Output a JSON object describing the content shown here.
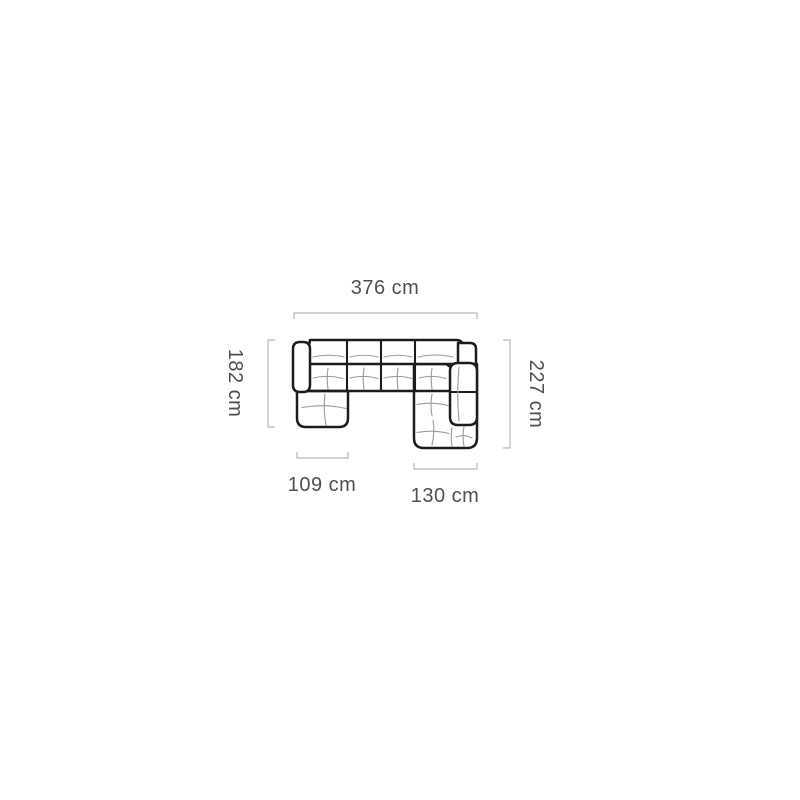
{
  "page": {
    "background_color": "#ffffff"
  },
  "diagram": {
    "subject": "u-shaped-corner-sofa-top-view",
    "unit": "cm",
    "dimensions": {
      "total_width": {
        "label": "376 cm",
        "value_cm": 376
      },
      "left_side_depth": {
        "label": "182 cm",
        "value_cm": 182
      },
      "right_side_depth": {
        "label": "227 cm",
        "value_cm": 227
      },
      "left_chaise_width": {
        "label": "109 cm",
        "value_cm": 109
      },
      "right_chaise_width": {
        "label": "130 cm",
        "value_cm": 130
      }
    },
    "colors": {
      "sofa_outline": "#1c1c1c",
      "seam_lines": "#9b9b9b",
      "dimension_lines": "#b8b8b8",
      "label_text": "#4f4f4f",
      "background": "#ffffff"
    }
  }
}
